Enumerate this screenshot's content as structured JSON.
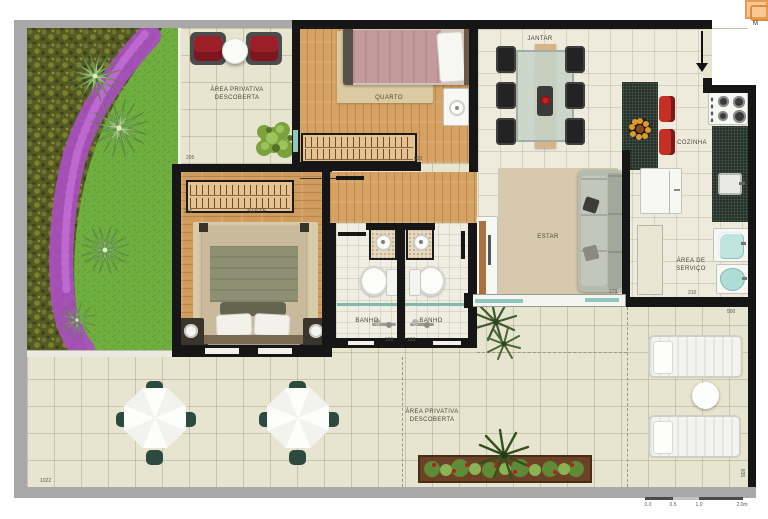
{
  "locator": {
    "label": "M"
  },
  "rooms": {
    "patio_top": {
      "line1": "ÁREA PRIVATIVA",
      "line2": "DESCOBERTA",
      "dim": "205"
    },
    "quarto": {
      "name": "QUARTO",
      "dim_closet": "020"
    },
    "suite": {
      "name": "SUITE",
      "dim": "279"
    },
    "banho_1": {
      "name": "BANHO",
      "dim": "120"
    },
    "banho_2": {
      "name": "BANHO",
      "dim": "120"
    },
    "jantar": {
      "name": "JANTAR"
    },
    "estar": {
      "name": "ESTAR",
      "dim": "279"
    },
    "cozinha": {
      "name": "COZINHA"
    },
    "servico": {
      "line1": "ÁREA DE",
      "line2": "SERVIÇO",
      "dim": "210",
      "dim_side": "500"
    },
    "terrace": {
      "line1": "ÁREA PRIVATIVA",
      "line2": "DESCOBERTA",
      "dim": "1022",
      "dim_side": "835"
    }
  },
  "scalebar": {
    "t0": "0.0",
    "t1": "0.5",
    "t2": "1.0",
    "t3": "2.0m"
  },
  "colors": {
    "wall": "#161616",
    "wood": "#d5a263",
    "tile_outdoor": "#e7e4cf",
    "tile_indoor": "#eeeadc",
    "grass": "#6fae3f",
    "shrub": "#545a22",
    "flowers": "#a94fc0",
    "counter_dark": "#26332b",
    "red_seat": "#9c2028",
    "stool_red": "#c43026",
    "teal_glass": "#8fc7bd",
    "frame_gray": "#a8a8a8",
    "locator_orange": "#f7c893"
  }
}
